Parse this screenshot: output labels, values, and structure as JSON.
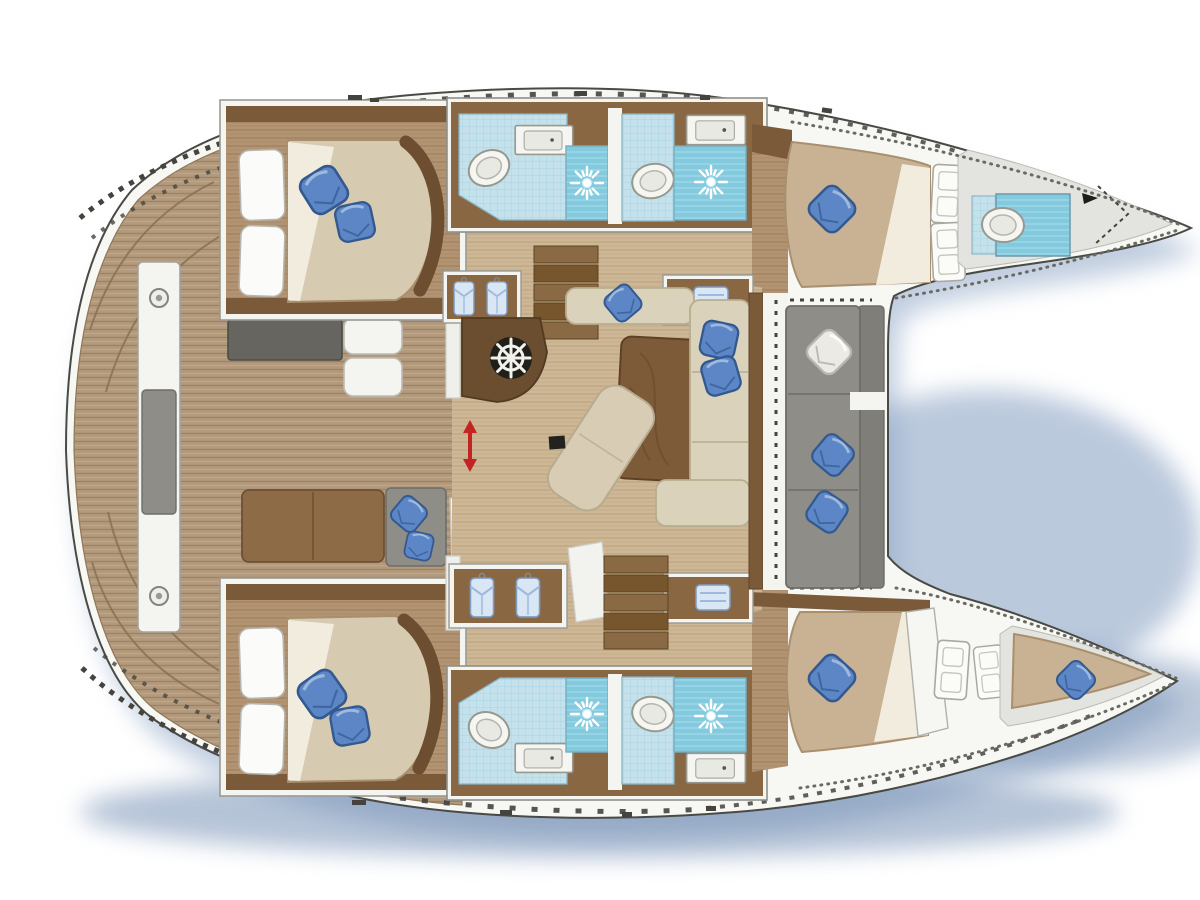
{
  "diagram": {
    "type": "catamaran-yacht-floor-plan",
    "orientation": "bows-pointing-right",
    "visible_features": {
      "double_beds": 4,
      "bow_v_berth": 1,
      "toilets": 5,
      "shower_sunburst_drains": 4,
      "sink_counters": 4,
      "wardrobes_with_hanging_clothes": 2,
      "towel_cabinets": 2,
      "companionway_stairs": 2,
      "helm_wheel": 1,
      "sliding_door_arrow": 1,
      "cockpit_gray_sofa_sections": 3,
      "blue_throw_pillows": 15,
      "white_diamond_pillow": 1,
      "cleat_circles": 2
    }
  },
  "icons": {
    "shower": "sunburst-drain-icon",
    "helm": "ships-wheel-icon",
    "wardrobe": "hanging-shirt-icon",
    "door_swing": "double-door-panel",
    "slide_indicator": "red-double-arrow-icon",
    "windlass": "anchor-winch-icon",
    "cleat": "round-cleat-icon"
  },
  "palette": {
    "page_bg": "#ffffff",
    "hull_fill": "#f7f7f4",
    "hull_stroke": "#4a4a45",
    "gray_deck": "#e3e3df",
    "deck": "#b39a7c",
    "deck_line": "#9d8266",
    "deck_line2": "#c3ab8d",
    "floor": "#cdb795",
    "floor_line": "#b89c7c",
    "cabin": "#b29472",
    "cabin_line": "#9a7c5c",
    "trim_dark": "#7b5a3a",
    "trim_mid": "#8a6743",
    "step_a": "#8a6a45",
    "step_b": "#77562e",
    "mattress": "#d6cab1",
    "mattress_fwd": "#c9b293",
    "mattress_edge": "#a8906e",
    "duvet": "#f2ecdf",
    "pillow_white": "#fbfbf9",
    "pillow": "#5c86c5",
    "pillow_dark": "#33598f",
    "pillow_light": "#9db9dd",
    "tile_light": "#c5e2ec",
    "tile_grid": "#9ecfdf",
    "tile_dark": "#83cadf",
    "tile_dark_line": "#a8dcea",
    "fixture": "#f5f5f2",
    "fixture_stroke": "#98988f",
    "white_panel": "#f4f4f1",
    "panel_stroke": "#b2b2ac",
    "cushion": "#8e8d87",
    "cushion_dark": "#6e6d67",
    "sofa_beige": "#dbd2bb",
    "sofa_beige_stroke": "#b8ad8f",
    "table": "#7d5b39",
    "table_dark": "#5e4124",
    "console": "#6b4d2f",
    "wheel_dark": "#211f1a",
    "accent_red": "#c32322",
    "shadow": "#8ea6c6",
    "shadow_deep": "#6d89b0",
    "dash_dark": "#45433e",
    "hatch_black": "#23221e"
  }
}
